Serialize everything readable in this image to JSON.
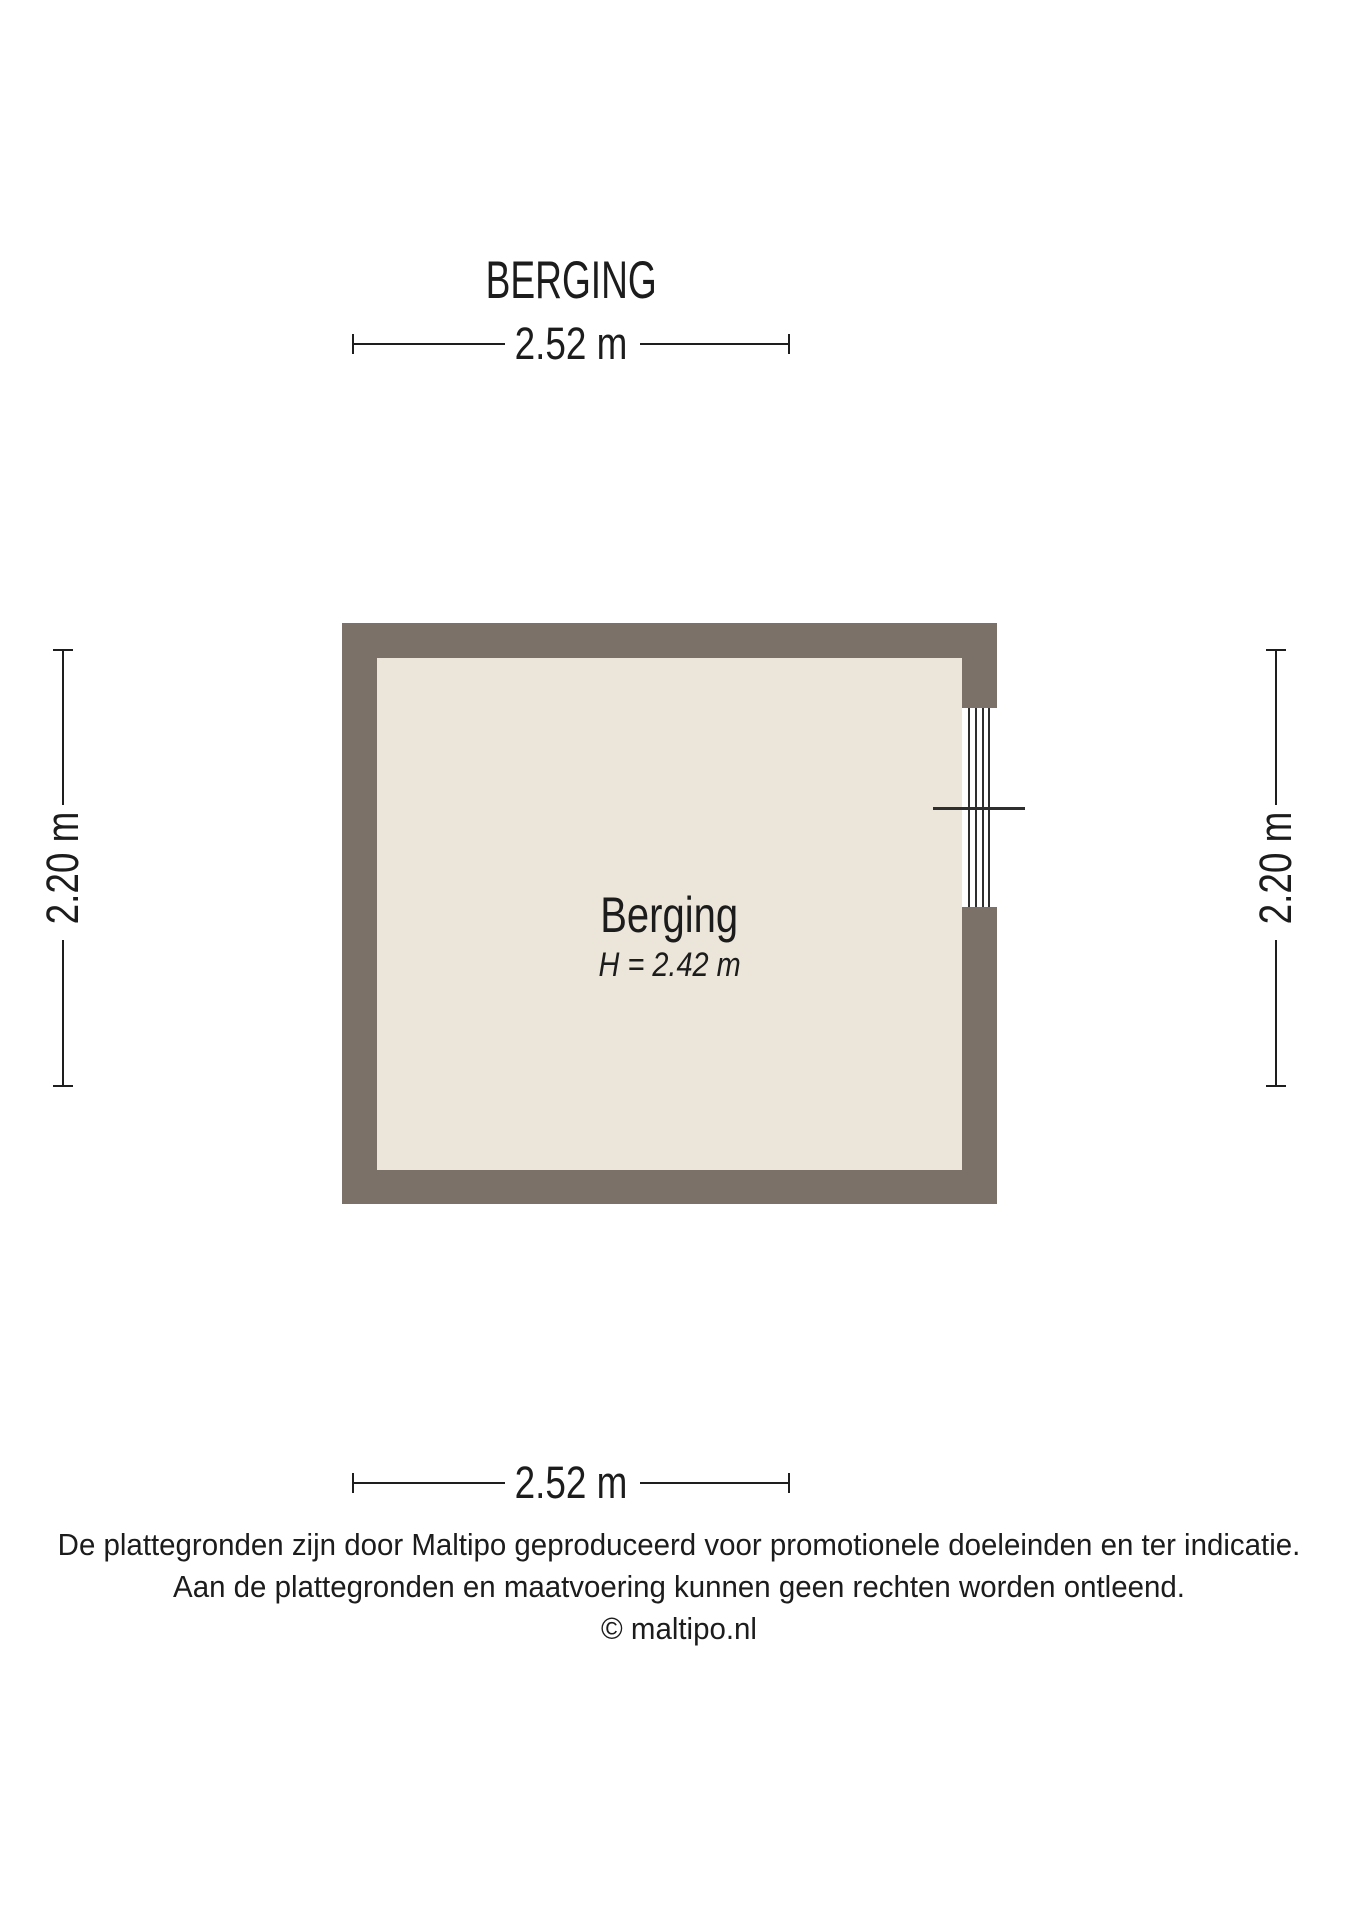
{
  "title": "BERGING",
  "floor_plan": {
    "room_label": "Berging",
    "room_height_label": "H = 2.42 m"
  },
  "dimensions": {
    "top": "2.52 m",
    "bottom": "2.52 m",
    "left": "2.20 m",
    "right": "2.20 m"
  },
  "footer": {
    "line1": "De plattegronden zijn door Maltipo geproduceerd voor promotionele doeleinden en ter indicatie.",
    "line2": "Aan de plattegronden en maatvoering kunnen geen rechten worden ontleend.",
    "line3": "© maltipo.nl"
  },
  "colors": {
    "background": "#FFFFFF",
    "wall": "#7C7168",
    "floor": "#ECE6DA",
    "dimension_line": "#1E1E1E",
    "window_line": "#2E2E2E",
    "text": "#1C1C1C"
  }
}
